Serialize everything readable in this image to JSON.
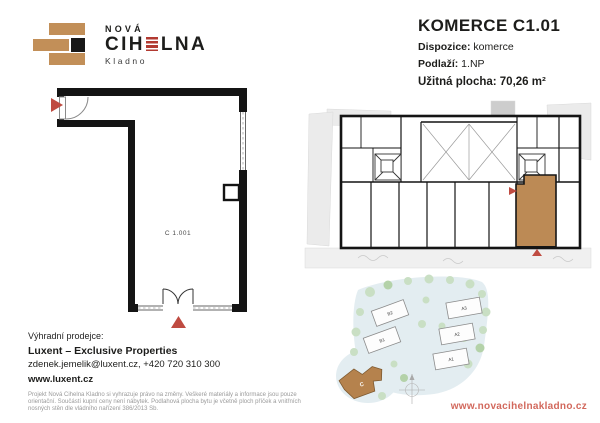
{
  "logo": {
    "nova": "NOVÁ",
    "cihelna_prefix": "CIH",
    "cihelna_suffix": "LNA",
    "city": "Kladno"
  },
  "header": {
    "title": "KOMERCE C1.01",
    "dispozice_label": "Dispozice:",
    "dispozice_value": " komerce",
    "podlazi_label": "Podlaží:",
    "podlazi_value": " 1.NP",
    "area_line": "Užitná plocha: 70,26 m²"
  },
  "unit_plan": {
    "room_label": "C 1.001"
  },
  "site_plan": {
    "labels": {
      "b2": "B2",
      "b1": "B1",
      "a3": "A3",
      "a2": "A2",
      "a1": "A1",
      "c": "C"
    }
  },
  "seller": {
    "heading": "Výhradní prodejce:",
    "name": "Luxent – Exclusive Properties",
    "contact": "zdenek.jemelik@luxent.cz, +420 720 310 300",
    "web": "www.luxent.cz"
  },
  "disclaimer": {
    "line1": "Projekt Nová Cihelna Kladno si vyhrazuje právo na změny. Veškeré materiály a informace jsou pouze",
    "line2": "orientační. Součástí kupní ceny není nábytek. Podlahová plocha bytu je včetně ploch příček a vnitřních",
    "line3": "nosných stěn dle vládního nařízení 386/2013 Sb."
  },
  "footer": {
    "website": "www.novacihelnakladno.cz"
  },
  "colors": {
    "accent_red": "#bf4b41",
    "brick_tan": "#c28f58",
    "unit_brown": "#bc8a55",
    "logo_red": "#b23a31",
    "footer_red": "#d2685c"
  }
}
